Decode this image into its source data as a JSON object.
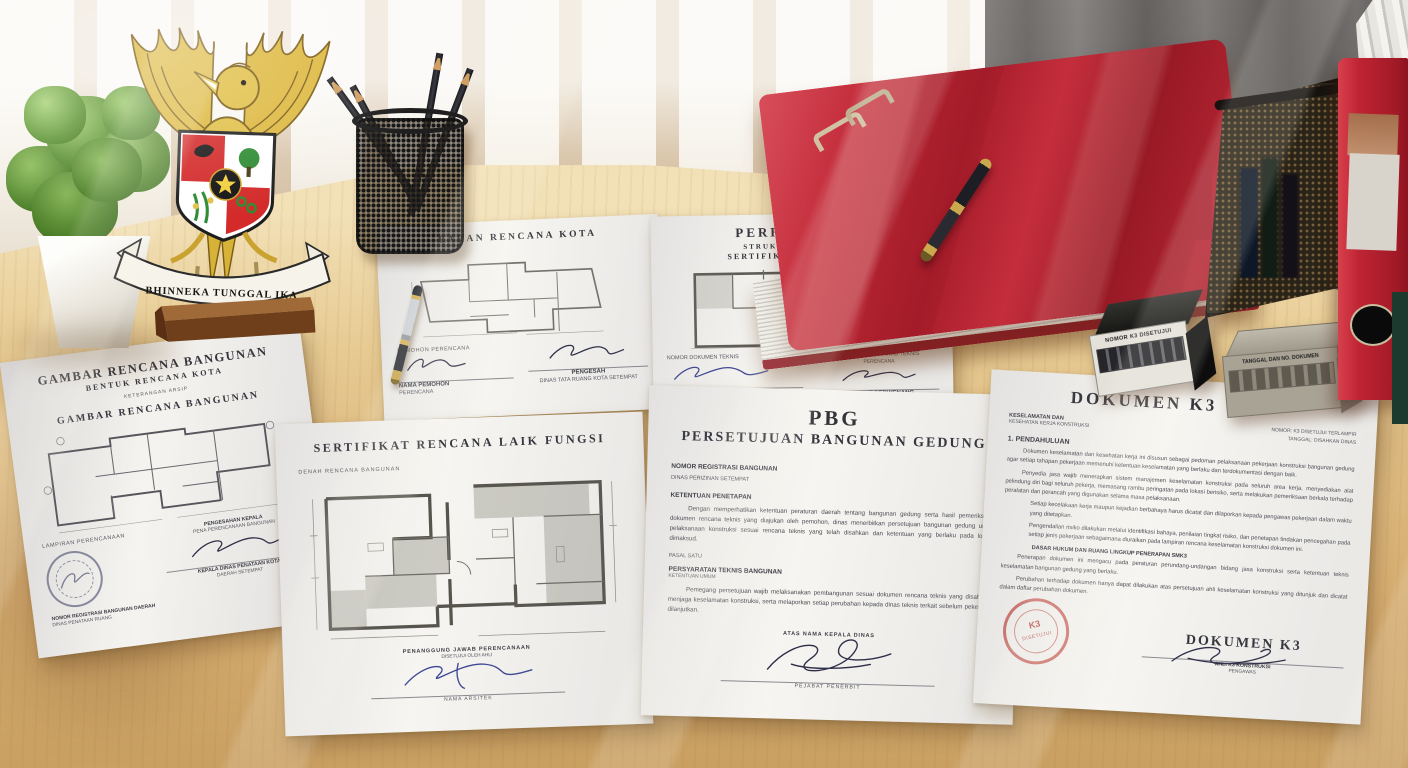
{
  "emblem": {
    "motto": "BHINNEKA TUNGGAL IKA"
  },
  "stamps": {
    "black_label": "NOMOR K3 DISETUJUI",
    "beige_label": "TANGGAL DAN NO. DOKUMEN",
    "red_line1": "K3",
    "red_line2": "DISETUJUI"
  },
  "docs": {
    "kota": {
      "title": "BAHAN RENCANA KOTA",
      "sig_left_top": "PEMOHON PERENCANA",
      "sig_left_name": "NAMA PEMOHON",
      "sig_left_sub": "PERENCANA",
      "sig_right_name": "PENGESAH",
      "sig_right_sub": "DINAS TATA RUANG KOTA SETEMPAT"
    },
    "perhit": {
      "title": "PERHITUNGAN",
      "line2": "STRUKTUR BANGUNAN",
      "line3": "SERTIFIKAT LAIK FUNGSI",
      "sig_left_top": "NOMOR DOKUMEN TEKNIS",
      "sig_left_name": "DINAS PENATAAN KOTA",
      "sig_left_sub": "PEMERIKSA TEKNIS",
      "sig_right_top": "PENANGGUNG JAWAB TEKNIS",
      "sig_right_top2": "PERENCANA",
      "sig_right_name": "PEJABAT BERWENANG",
      "sig_right_sub": "NOMOR REGISTRASI"
    },
    "gambar": {
      "title": "GAMBAR RENCANA BANGUNAN",
      "subtitle": "BENTUK RENCANA KOTA",
      "tagline": "KETERANGAN ARSIP",
      "title2": "GAMBAR RENCANA BANGUNAN",
      "left_label": "LAMPIRAN PERENCANAAN",
      "right_top": "PENGESAHAN KEPALA",
      "right_line": "PENA PERENCANAAN BANGUNAN",
      "right_name": "KEPALA DINAS PENATAAN KOTA",
      "right_sub": "DAERAH SETEMPAT",
      "bottom1": "NOMOR REGISTRASI BANGUNAN DAERAH",
      "bottom2": "DINAS PENATAAN RUANG"
    },
    "cert": {
      "title": "SERTIFIKAT RENCANA LAIK FUNGSI",
      "plan_label": "DENAH RENCANA BANGUNAN",
      "sig_top": "PENANGGUNG JAWAB PERENCANAAN",
      "sig_pre": "DISETUJUI OLEH AHLI",
      "sig_name": "NAMA ARSITEK"
    },
    "pbg": {
      "title": "PBG",
      "subtitle": "PERSETUJUAN BANGUNAN GEDUNG",
      "h1": "NOMOR REGISTRASI BANGUNAN",
      "h1b": "DINAS PERIZINAN SETEMPAT",
      "h2": "KETENTUAN PENETAPAN",
      "para1": "Dengan memperhatikan ketentuan peraturan daerah tentang bangunan gedung serta hasil pemeriksaan dokumen rencana teknis yang diajukan oleh pemohon, dinas menerbitkan persetujuan bangunan gedung untuk pelaksanaan konstruksi sesuai rencana teknis yang telah disahkan dan ketentuan yang berlaku pada lokasi dimaksud.",
      "s1": "PASAL SATU",
      "h3": "PERSYARATAN TEKNIS BANGUNAN",
      "h3b": "KETENTUAN UMUM",
      "para2": "Pemegang persetujuan wajib melaksanakan pembangunan sesuai dokumen rencana teknis yang disahkan, menjaga keselamatan konstruksi, serta melaporkan setiap perubahan kepada dinas teknis terkait sebelum pekerjaan dilanjutkan.",
      "sig_top": "ATAS NAMA KEPALA DINAS",
      "sig_name": "PEJABAT PENERBIT"
    },
    "k3": {
      "title": "DOKUMEN K3",
      "hl1": "KESELAMATAN DAN",
      "hl2": "KESEHATAN KERJA KONSTRUKSI",
      "hr1": "NOMOR: K3 DISETUJUI TERLAMPIR",
      "hr2": "TANGGAL: DISAHKAN DINAS",
      "s1": "1.  PENDAHULUAN",
      "p1": "Dokumen keselamatan dan kesehatan kerja ini disusun sebagai pedoman pelaksanaan pekerjaan konstruksi bangunan gedung agar setiap tahapan pekerjaan memenuhi ketentuan keselamatan yang berlaku dan terdokumentasi dengan baik.",
      "p2": "Penyedia jasa wajib menerapkan sistem manajemen keselamatan konstruksi pada seluruh area kerja, menyediakan alat pelindung diri bagi seluruh pekerja, memasang rambu peringatan pada lokasi berisiko, serta melakukan pemeriksaan berkala terhadap peralatan dan perancah yang digunakan selama masa pelaksanaan.",
      "p3": "Setiap kecelakaan kerja maupun kejadian berbahaya harus dicatat dan dilaporkan kepada pengawas pekerjaan dalam waktu yang ditetapkan.",
      "p4": "Pengendalian risiko dilakukan melalui identifikasi bahaya, penilaian tingkat risiko, dan penetapan tindakan pencegahan pada setiap jenis pekerjaan sebagaimana diuraikan pada lampiran rencana keselamatan konstruksi dokumen ini.",
      "mid": "DASAR HUKUM DAN RUANG LINGKUP PENERAPAN SMK3",
      "p5": "Penerapan dokumen ini mengacu pada peraturan perundang-undangan bidang jasa konstruksi serta ketentuan teknis keselamatan bangunan gedung yang berlaku.",
      "p6": "Perubahan terhadap dokumen hanya dapat dilakukan atas persetujuan ahli keselamatan konstruksi yang ditunjuk dan dicatat dalam daftar perubahan dokumen.",
      "bottom_title": "DOKUMEN K3",
      "sig_name": "AHLI K3 KONSTRUKSI",
      "sig_sub": "PENGAWAS"
    }
  }
}
